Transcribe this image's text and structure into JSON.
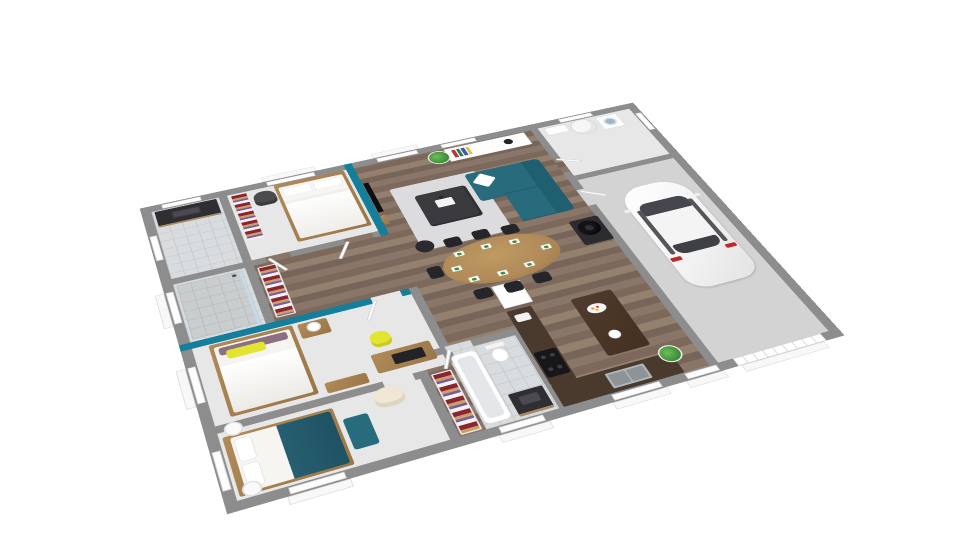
{
  "meta": {
    "view": "3d-isometric-floorplan-render",
    "background": "#ffffff"
  },
  "palette": {
    "wall": "#8d8d8d",
    "wall_light": "#b5b5b5",
    "wood": "#8a7668",
    "wood_dark": "#78655a",
    "wood_furniture": "#b08a58",
    "bedroom_floor": "#e7e7e7",
    "tile": "#d9dcde",
    "tile_line": "#c3c8cb",
    "concrete": "#d3d3d3",
    "teal": "#157f9b",
    "sofa_teal": "#276b7c",
    "duvet_teal": "#275f70",
    "yellow": "#e3e42f",
    "rug": "#dcdcde",
    "dark": "#3a3a3f",
    "black": "#17171a",
    "counter": "#4a392d",
    "cream": "#efe6d4",
    "plum": "#8d7080",
    "green": "#3f8f3a",
    "clothes_red": "#8e2430",
    "clothes_tan": "#c9a06a",
    "clothes_purple": "#7a5a9e",
    "car_body": "#f2f2f2",
    "car_glass": "#46464e",
    "taillight": "#c1272d"
  },
  "scene": {
    "building": "single-storey house with attached garage, cut-wall 3D top view",
    "rooms": [
      {
        "name": "living-room",
        "floor": "wood",
        "furniture": [
          "teal-sofa",
          "white-cushion",
          "rug",
          "ottoman-coffee-table",
          "tray",
          "black-pouf",
          "tv-accent-wall",
          "tv",
          "wall-shelf",
          "sideboard",
          "books",
          "bowl",
          "plant"
        ]
      },
      {
        "name": "dining-area",
        "floor": "wood",
        "furniture": [
          "oval-wood-table",
          "place-settings",
          "black-chairs",
          "wood-stove"
        ]
      },
      {
        "name": "kitchen",
        "floor": "wood",
        "furniture": [
          "l-shaped-counter",
          "cooktop",
          "double-sink",
          "island",
          "fruit-bowl",
          "tall-cabinet",
          "floor-plant"
        ]
      },
      {
        "name": "utility-room",
        "floor": "light",
        "furniture": [
          "washing-machine",
          "water-heater",
          "cabinet"
        ]
      },
      {
        "name": "garage",
        "floor": "concrete",
        "furniture": [
          "white-car",
          "garage-door"
        ]
      },
      {
        "name": "bedroom-1",
        "floor": "light",
        "furniture": [
          "double-bed-white",
          "dark-chair",
          "wardrobe"
        ]
      },
      {
        "name": "bedroom-2",
        "floor": "light",
        "furniture": [
          "double-bed-yellow-pillow",
          "plum-pillow",
          "nightstand",
          "lamp",
          "desk",
          "yellow-chair",
          "dresser",
          "teal-accent-wall"
        ]
      },
      {
        "name": "bedroom-3",
        "floor": "light",
        "furniture": [
          "double-bed-teal-duvet",
          "teal-bench",
          "cream-armchair",
          "round-side-tables",
          "wardrobe"
        ]
      },
      {
        "name": "bathroom-1",
        "floor": "tile",
        "furniture": [
          "dark-vanity",
          "walk-in-shower",
          "glass-screen"
        ]
      },
      {
        "name": "bathroom-2",
        "floor": "tile",
        "furniture": [
          "bathtub",
          "toilet",
          "dark-vanity"
        ]
      },
      {
        "name": "hallway",
        "floor": "wood",
        "furniture": [
          "wardrobe"
        ]
      }
    ],
    "counts": {
      "bedrooms": 3,
      "bathrooms": 2,
      "dining_chairs": 7,
      "dining_place_settings": 8,
      "cars": 1,
      "wardrobe_niches": 3,
      "doors": 7
    }
  }
}
